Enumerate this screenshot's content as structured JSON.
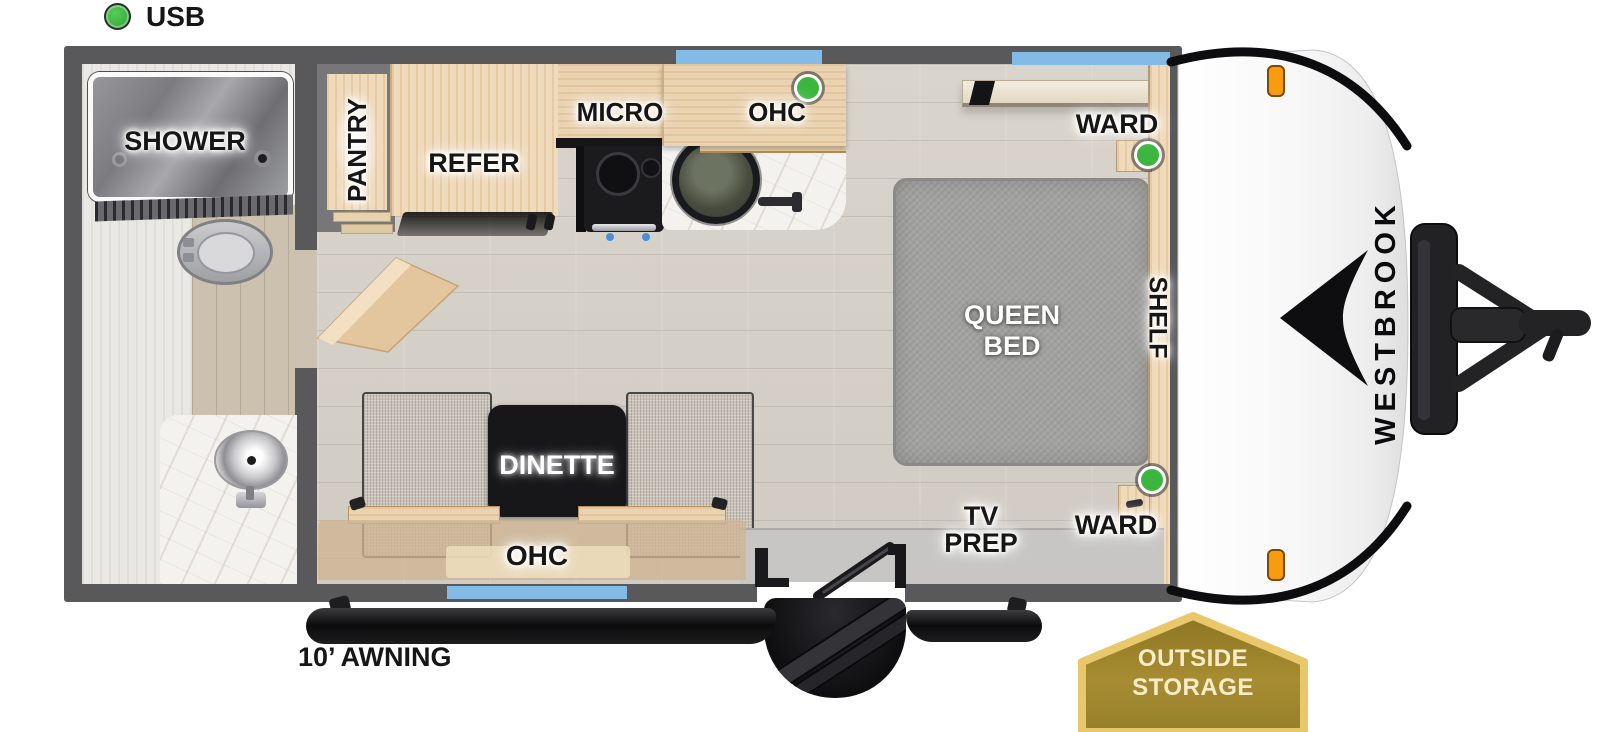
{
  "legend": {
    "usb": "USB"
  },
  "labels": {
    "shower": "SHOWER",
    "pantry": "PANTRY",
    "refer": "REFER",
    "micro": "MICRO",
    "ohc_kitchen": "OHC",
    "ward_top": "WARD",
    "ward_bottom": "WARD",
    "queen_bed_l1": "QUEEN",
    "queen_bed_l2": "BED",
    "shelf": "SHELF",
    "tv_prep_l1": "TV",
    "tv_prep_l2": "PREP",
    "dinette": "DINETTE",
    "ohc_dinette": "OHC",
    "awning": "10’ AWNING",
    "outside_storage_l1": "OUTSIDE",
    "outside_storage_l2": "STORAGE",
    "brand": "WESTBROOK"
  },
  "colors": {
    "wall_gray": "#59595c",
    "window_blue": "#84bbe6",
    "usb_green": "#3cb63f",
    "wood_light": "#efdabb",
    "bed_gray": "#a2a2a0",
    "awning_black": "#151517",
    "badge_gold": "#9d8229",
    "badge_border": "#e9c76b",
    "marker_orange": "#f79b10"
  }
}
